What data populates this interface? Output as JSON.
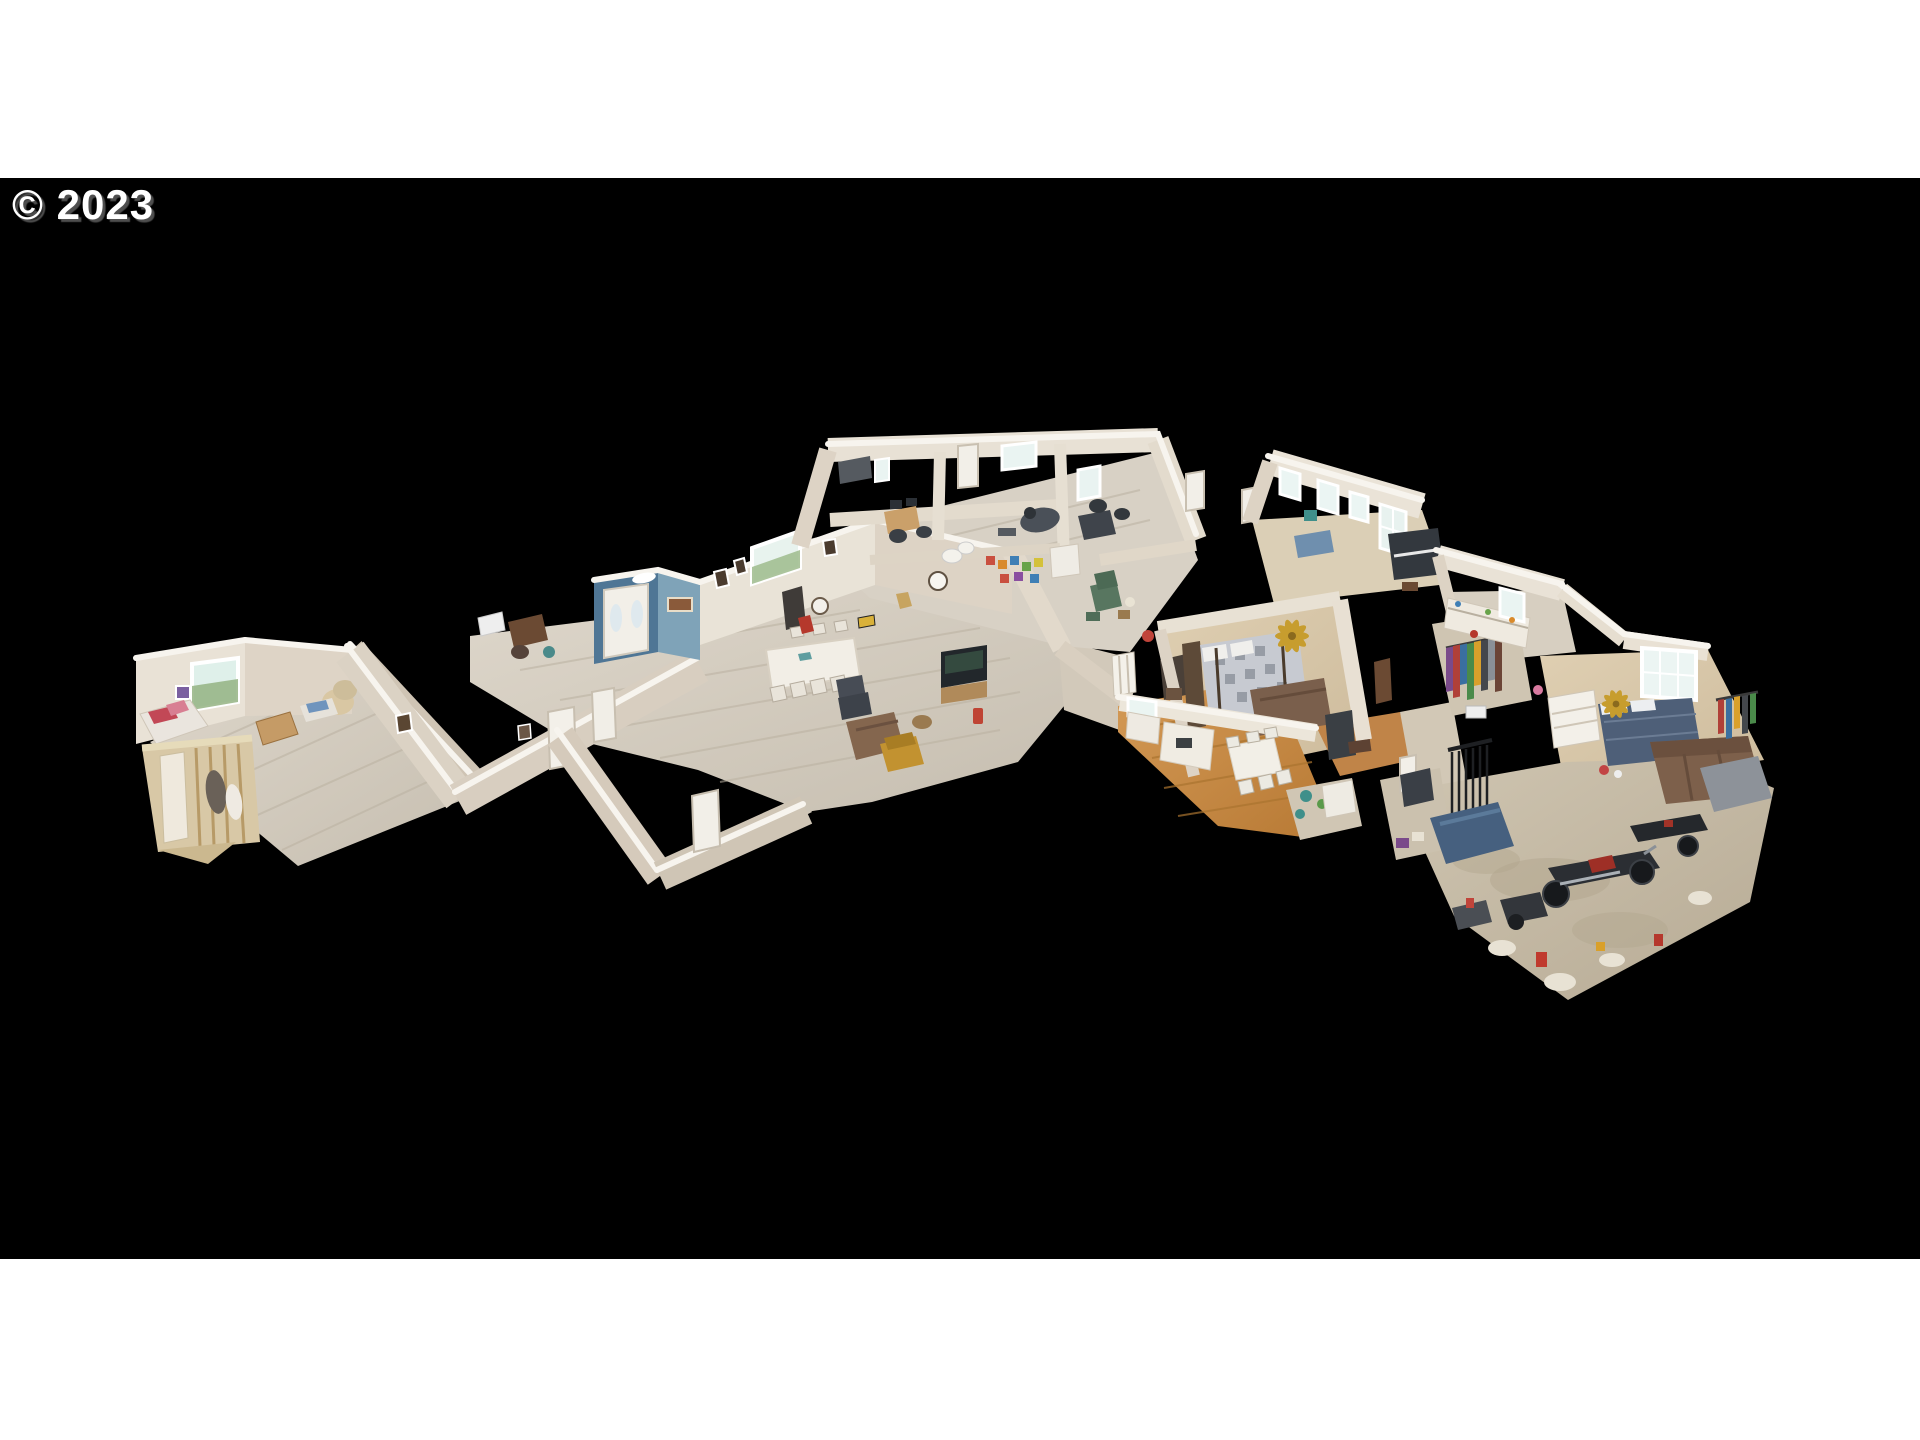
{
  "watermark": {
    "text": "© 2023",
    "color": "#ffffff",
    "shadow_color": "#525252"
  },
  "canvas": {
    "background": "#000000",
    "letterbox_top_color": "#ffffff",
    "letterbox_bottom_color": "#ffffff"
  },
  "scene": {
    "type": "3d-dollhouse-cutaway-home-scan",
    "regions": [
      "left-bedroom",
      "left-closet",
      "zigzag-hallway",
      "blue-entry-foyer",
      "dining-living-room",
      "upper-rooms-wing",
      "sunroom",
      "master-bedroom",
      "kitchen",
      "right-hall-stairs",
      "closet-racks",
      "kitchenette",
      "right-bedroom",
      "garage"
    ],
    "palette": {
      "wall": "#e9e2d6",
      "wall_shadow": "#cfc5b6",
      "wall_top_edge": "#f7f4ee",
      "floor_wood_gray": "#d5cec3",
      "floor_wood_honey": "#c98f4a",
      "carpet_tan": "#d9c8ac",
      "concrete": "#c9bfab",
      "accent_blue_wall": "#4f7695",
      "window_glow": "#ebf5f3",
      "window_greenery": "#94b383",
      "furniture_dark": "#33383e",
      "couch_brown": "#7d604b",
      "recliner_green": "#587660",
      "bed_navy": "#4e5f78",
      "fan_gold": "#c79d2e",
      "accent_red": "#b5382c",
      "mustard_chair": "#c29230"
    }
  }
}
